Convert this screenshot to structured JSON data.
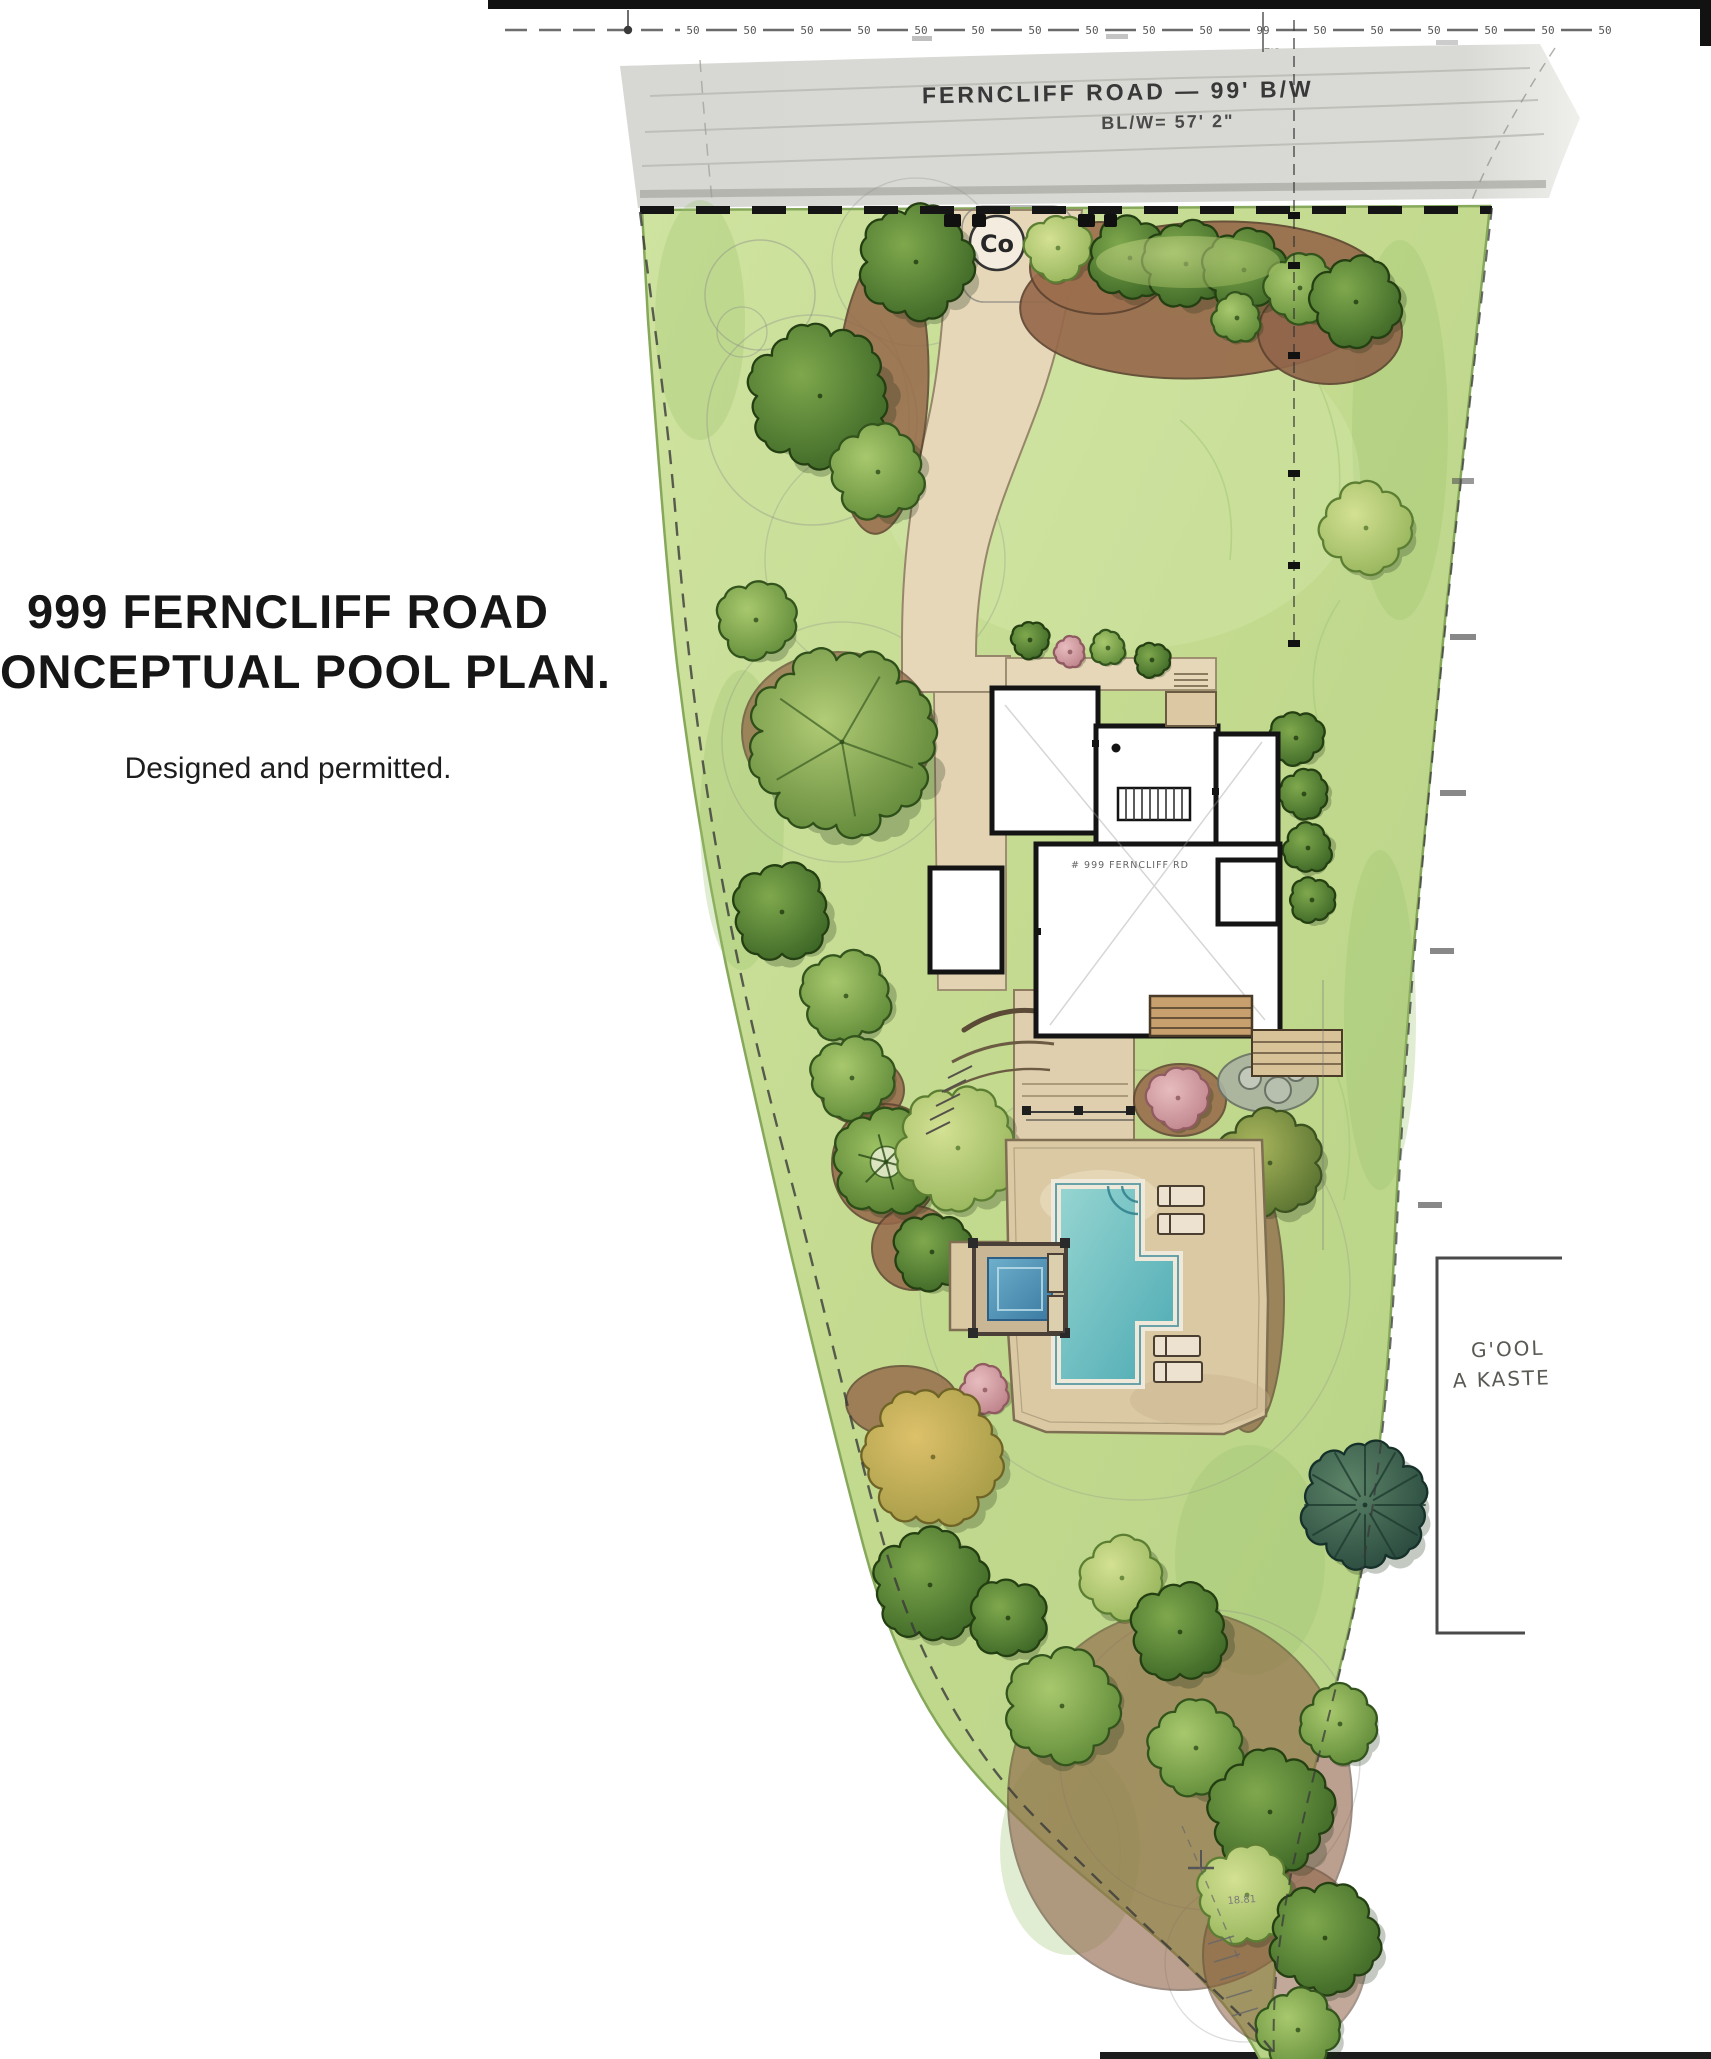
{
  "title": {
    "line1": "999 FERNCLIFF ROAD",
    "line2": "CONCEPTUAL POOL PLAN.",
    "subtitle": "Designed and permitted."
  },
  "road": {
    "name_label": "FERNCLIFF ROAD — 99' B/W",
    "width_label": "BL/W= 57' 2\""
  },
  "ruler": {
    "ticks": [
      "50",
      "50",
      "50",
      "50",
      "50",
      "50",
      "50",
      "50",
      "50",
      "50",
      "99",
      "50",
      "50",
      "50",
      "50",
      "50",
      "50"
    ],
    "sub_mark": "7'8"
  },
  "survey": {
    "curb_marker": "Co",
    "pool_note_line1": "G'OOL",
    "pool_note_line2": "A KASTE",
    "bottom_mark": "18.81"
  },
  "house": {
    "label": "# 999 FERNCLIFF RD"
  },
  "colors": {
    "road_gray": "#d7d7d3",
    "lawn_green": "#c5dd96",
    "path_beige": "#e6d7b8",
    "patio_tan": "#dbc9a4",
    "mulch_brown": "#96684a",
    "pool_teal": "#5fb6bb",
    "spa_blue": "#4f93b8",
    "ink": "#1b1b1b"
  },
  "plan": {
    "trees": [
      [
        916,
        262,
        56,
        "dark"
      ],
      [
        1058,
        248,
        32,
        "light"
      ],
      [
        1130,
        258,
        40,
        "dark"
      ],
      [
        1186,
        264,
        42,
        "dark"
      ],
      [
        1244,
        270,
        40,
        "dark"
      ],
      [
        1300,
        288,
        34,
        "green"
      ],
      [
        1237,
        318,
        24,
        "green"
      ],
      [
        1356,
        302,
        44,
        "dark"
      ],
      [
        1366,
        528,
        44,
        "light"
      ],
      [
        820,
        396,
        70,
        "dark"
      ],
      [
        878,
        472,
        46,
        "green"
      ],
      [
        756,
        620,
        38,
        "green"
      ],
      [
        842,
        742,
        92,
        "branched"
      ],
      [
        782,
        912,
        48,
        "dark"
      ],
      [
        846,
        996,
        44,
        "green"
      ],
      [
        852,
        1078,
        40,
        "green"
      ],
      [
        886,
        1162,
        52,
        "pin"
      ],
      [
        958,
        1148,
        60,
        "light"
      ],
      [
        932,
        1252,
        38,
        "dark"
      ],
      [
        1296,
        738,
        26,
        "dark"
      ],
      [
        1304,
        794,
        24,
        "dark"
      ],
      [
        1308,
        848,
        24,
        "dark"
      ],
      [
        1312,
        900,
        22,
        "dark"
      ],
      [
        1030,
        640,
        18,
        "dark"
      ],
      [
        1070,
        652,
        15,
        "pink"
      ],
      [
        1108,
        648,
        17,
        "green"
      ],
      [
        1152,
        660,
        17,
        "dark"
      ],
      [
        1178,
        1098,
        30,
        "pink"
      ],
      [
        1270,
        1163,
        52,
        "olive"
      ],
      [
        1232,
        1255,
        24,
        "dark"
      ],
      [
        1238,
        1310,
        24,
        "dark"
      ],
      [
        1242,
        1365,
        22,
        "dark"
      ],
      [
        985,
        1390,
        24,
        "pink"
      ],
      [
        933,
        1457,
        68,
        "gold"
      ],
      [
        930,
        1585,
        55,
        "dark"
      ],
      [
        1365,
        1505,
        62,
        "conifer"
      ],
      [
        1008,
        1618,
        38,
        "dark"
      ],
      [
        1062,
        1706,
        56,
        "green"
      ],
      [
        1122,
        1578,
        40,
        "light"
      ],
      [
        1180,
        1632,
        48,
        "dark"
      ],
      [
        1196,
        1748,
        46,
        "green"
      ],
      [
        1270,
        1812,
        60,
        "dark"
      ],
      [
        1340,
        1724,
        38,
        "green"
      ],
      [
        1247,
        1895,
        48,
        "light"
      ],
      [
        1325,
        1938,
        54,
        "dark"
      ],
      [
        1298,
        2030,
        40,
        "green"
      ]
    ]
  }
}
